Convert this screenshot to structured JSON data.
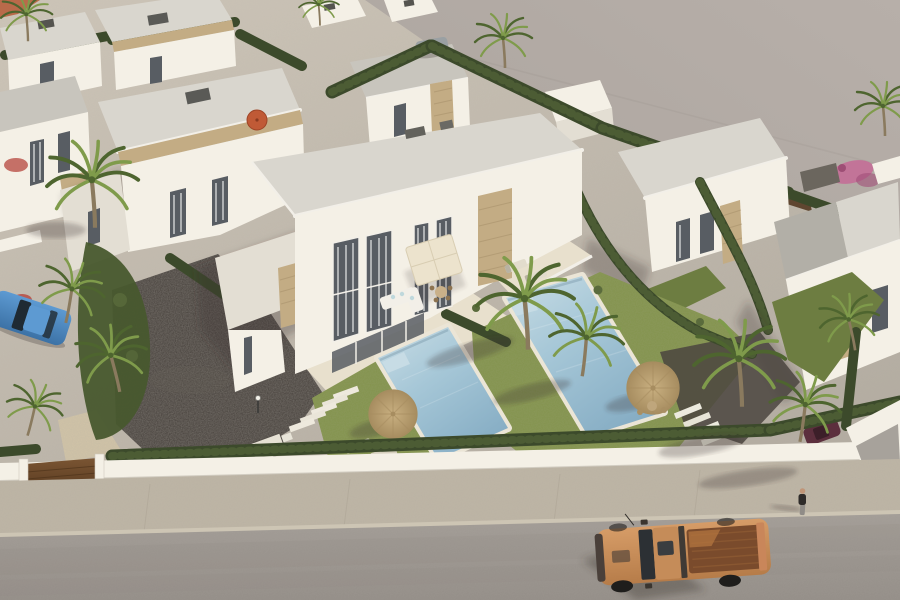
{
  "meta": {
    "type": "3d-architectural-aerial-render",
    "alt": "Aerial 3D render of a modern white villa development: a central duplex villa with two turquoise pools, lawns, palm trees, straw umbrellas, cypress hedges, a gravel courtyard, surrounding white flat-roof villas, a vacant grey lot, and a street with a tan pickup truck and a pedestrian.",
    "canvas": {
      "width": 900,
      "height": 600
    }
  },
  "objects": [
    {
      "name": "central-duplex-villa"
    },
    {
      "name": "left-pool"
    },
    {
      "name": "right-pool"
    },
    {
      "name": "neighboring-villas"
    },
    {
      "name": "vacant-lot"
    },
    {
      "name": "street"
    },
    {
      "name": "sidewalk"
    },
    {
      "name": "perimeter-wall"
    },
    {
      "name": "entrance-gate"
    },
    {
      "name": "gravel-courtyard"
    },
    {
      "name": "stepping-stones"
    },
    {
      "name": "garden-steps"
    },
    {
      "name": "straw-umbrellas"
    },
    {
      "name": "orange-parasol"
    },
    {
      "name": "cream-parasol"
    },
    {
      "name": "sun-loungers"
    },
    {
      "name": "outdoor-sofa"
    },
    {
      "name": "palm-trees"
    },
    {
      "name": "cypress-hedges"
    },
    {
      "name": "bougainvillea"
    },
    {
      "name": "lawns"
    },
    {
      "name": "pickup-truck"
    },
    {
      "name": "pedestrian"
    },
    {
      "name": "blue-car"
    },
    {
      "name": "grey-parked-car"
    },
    {
      "name": "maroon-parked-car"
    },
    {
      "name": "lamp-post"
    }
  ],
  "palette": {
    "lot1": "#b7afa9",
    "lot2": "#a19a94",
    "ground1": "#cdc5b8",
    "ground2": "#b2aba0",
    "road1": "#a39d97",
    "road2": "#948e88",
    "sidewalk": "#beb5a5",
    "curb": "#cdc5b4",
    "wallWhite": "#f4f0e6",
    "whiteShade": "#e3ded3",
    "whiteDark": "#cfcabf",
    "roofLight": "#d9d6ce",
    "roof": "#c8c5bd",
    "roofDark": "#b2afa7",
    "stone": "#c3ac84",
    "stoneDark": "#9f8963",
    "glass": "#585d63",
    "curtain": "#d3d5d6",
    "frame": "#f2efe8",
    "hedge": "#3c4a2b",
    "hedgeLight": "#5a6b3c",
    "grass1": "#84944e",
    "grass2": "#6d7d41",
    "palmTrunk": "#8a7a5e",
    "palmDark": "#4e652f",
    "palmLight": "#7f9b4b",
    "pool1": "#c9dde5",
    "pool2": "#a6c7d7",
    "pool3": "#86adc4",
    "coping": "#ebe5d6",
    "terrace": "#e8e0cd",
    "gravel": "#4b4540",
    "gravelLight": "#6b645c",
    "driveway": "#d0c3a7",
    "straw": "#c9b081",
    "strawDark": "#a78d60",
    "orangeUmb": "#c05a36",
    "truck1": "#d69c67",
    "truck2": "#b67c49",
    "truckBed": "#7a4b2c",
    "bedLight": "#b3743f",
    "grille": "#4a403a",
    "tire": "#1f1e1c",
    "glassDark": "#2c3034",
    "blue1": "#5d9ad2",
    "blue2": "#3c72a6",
    "grayCar": "#9aa0a3",
    "maroon": "#5c2f3d",
    "skin": "#c09577",
    "coat": "#2e2b29",
    "pants": "#908c87",
    "pink": "#c46a95",
    "red": "#b5453c",
    "terracotta": "#b96a4a",
    "gate1": "#7a5533",
    "gate2": "#5c3d22",
    "fence": "#5f4630",
    "lamp": "#3a3a38",
    "lounger": "#e2dccc",
    "shadow": "rgba(58,52,46,0.45)",
    "shadowSoft": "rgba(58,52,46,0.28)"
  }
}
